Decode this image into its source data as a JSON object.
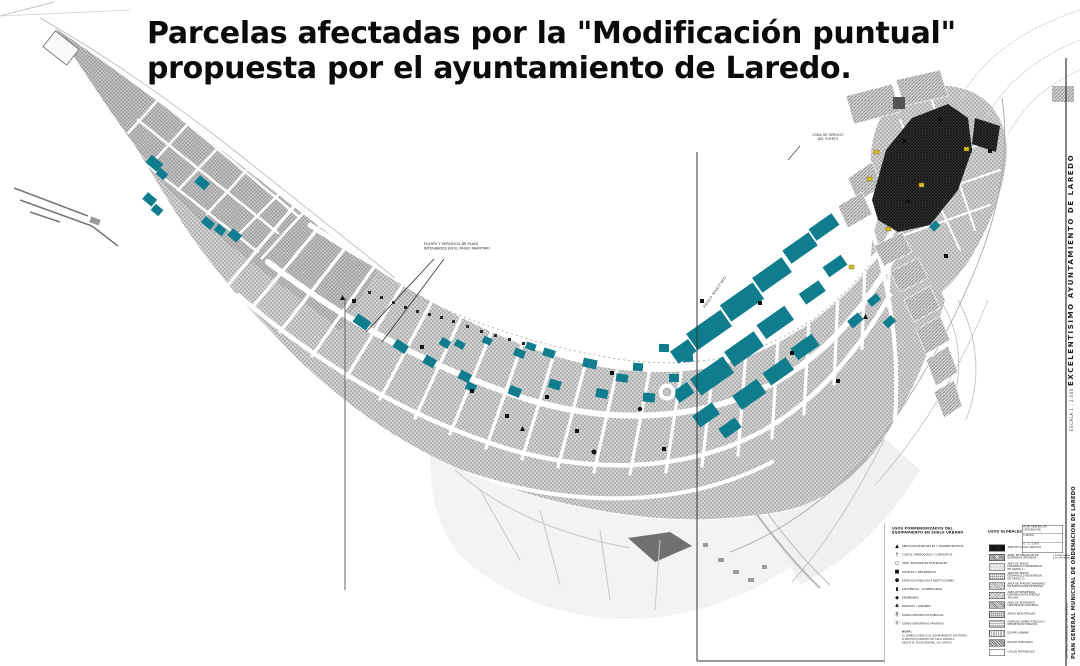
{
  "title": {
    "line1": "Parcelas afectadas por la \"Modificación puntual\"",
    "line2": "propuesta por el ayuntamiento de Laredo."
  },
  "map": {
    "annotations": {
      "playa_note_line1": "EQUIPO Y SERVICIOS DE PLAYA",
      "playa_note_line2": "INTEGRADOS EN EL PASEO MARITIMO",
      "puerto_note_line1": "ZONA DE SERVICIO",
      "puerto_note_line2": "DEL PUERTO",
      "paseo_label": "PASEO MARITIMO"
    },
    "colors": {
      "parcel_teal": "#0f7d8d",
      "old_town_dark": "#3d3d3d",
      "band_gray": "#c9c9c9",
      "accent_yellow": "#d6b91f"
    }
  },
  "margin": {
    "ayuntamiento_main": "EXCELENTISIMO  AYUNTAMIENTO  DE  LAREDO",
    "ayuntamiento_sub": "ESCALA  1 : 2.000",
    "plan_main": "PLAN GENERAL MUNICIPAL DE ORDENACION DE LAREDO",
    "plan_sub1": "CLASIFICACION Y CALIFICACION DEL SUELO",
    "plan_sub2": "TERMINO MUNICIPAL DE LAREDO"
  },
  "legend": {
    "equipamiento": {
      "header1": "USOS PORMENORIZADOS DEL",
      "header2": "EQUIPAMIENTO EN SUELO URBANO",
      "items": [
        {
          "glyph": "▲",
          "label": "SERVICIOS MUNICIPALES Y ADMINISTRATIVOS"
        },
        {
          "glyph": "†",
          "label": "CULTOS, PARROQUIAS Y CONVENTOS"
        },
        {
          "glyph": "○",
          "label": "UNID. PEATONALES ESTANCIALES"
        },
        {
          "glyph": "■",
          "label": "HOTELES Y RESIDENCIAS"
        },
        {
          "glyph": "●",
          "label": "EDIFICIOS PUBLICOS E INSTITUCIONES"
        },
        {
          "glyph": "▮",
          "label": "ASISTENCIAL - DISPENSARIOS"
        },
        {
          "glyph": "◆",
          "label": "ENSEÑANZA"
        },
        {
          "glyph": "♣",
          "label": "PARQUES Y JARDINES"
        },
        {
          "glyph": "Ⓑ",
          "label": "ZONAS DEPORTIVAS PUBLICAS"
        },
        {
          "glyph": "ⓓ",
          "label": "ZONAS DEPORTIVAS PRIVADAS"
        }
      ],
      "note_title": "NOTA:",
      "note_line1": "EL SIMBOLO INDICA EL EQUIPAMIENTO EXISTENTE",
      "note_line2": "O PREVISTO DENTRO DE CADA PARCELA",
      "note_line3": "SEGUN EL PLAN GENERAL DE LAREDO"
    },
    "globales": {
      "header": "USOS GLOBALES",
      "items": [
        {
          "pattern": "crossdark",
          "label": "AREA DE CASCO ANTIGUO",
          "mark": "",
          "note": ""
        },
        {
          "pattern": "dense5",
          "label": "ZONA DE ENSANCHE EN EXTENSION INTENSIVA",
          "mark": "5",
          "note": "NUEVAS AREAS INCORPORADAS"
        },
        {
          "pattern": "dotsA",
          "label": "AREA DE NUEVO DESARROLLO RESIDENCIAL EN GRADO 1º",
          "mark": "",
          "note": ""
        },
        {
          "pattern": "dotsB",
          "label": "AREA DE NUEVO DESARROLLO RESIDENCIAL EN GRADO 2º",
          "mark": "",
          "note": ""
        },
        {
          "pattern": "diagA",
          "label": "AREA DE APROVECHAMIENTO EN EDIFICACION EXTENSIVA",
          "mark": "",
          "note": ""
        },
        {
          "pattern": "diagB",
          "label": "AREA DE RESIDENCIA UNIFAMILIAR EN PARCELA AISLADA",
          "mark": "",
          "note": ""
        },
        {
          "pattern": "diagC",
          "label": "AREA DE RESIDENCIA UNIFAMILIAR AGRUPADA",
          "mark": "",
          "note": ""
        },
        {
          "pattern": "gridA",
          "label": "AREAS INDUSTRIALES",
          "mark": "",
          "note": ""
        },
        {
          "pattern": "horizA",
          "label": "ESPACIOS LIBRES PUBLICOS Y DEPORTIVOS PUBLICOS",
          "mark": "",
          "note": ""
        },
        {
          "pattern": "vertA",
          "label": "EQUIPO URBANO",
          "mark": "",
          "note": ""
        },
        {
          "pattern": "diagD",
          "label": "EQUIPO PORTUARIO",
          "mark": "",
          "note": ""
        },
        {
          "pattern": "blank",
          "label": "CALLES PEATONALES",
          "mark": "",
          "note": ""
        }
      ]
    },
    "titleblock": {
      "line1": "PLAN GENERAL DE ORDENACION",
      "line2": "LAREDO",
      "line3": "E : 1 / 2.000"
    }
  }
}
